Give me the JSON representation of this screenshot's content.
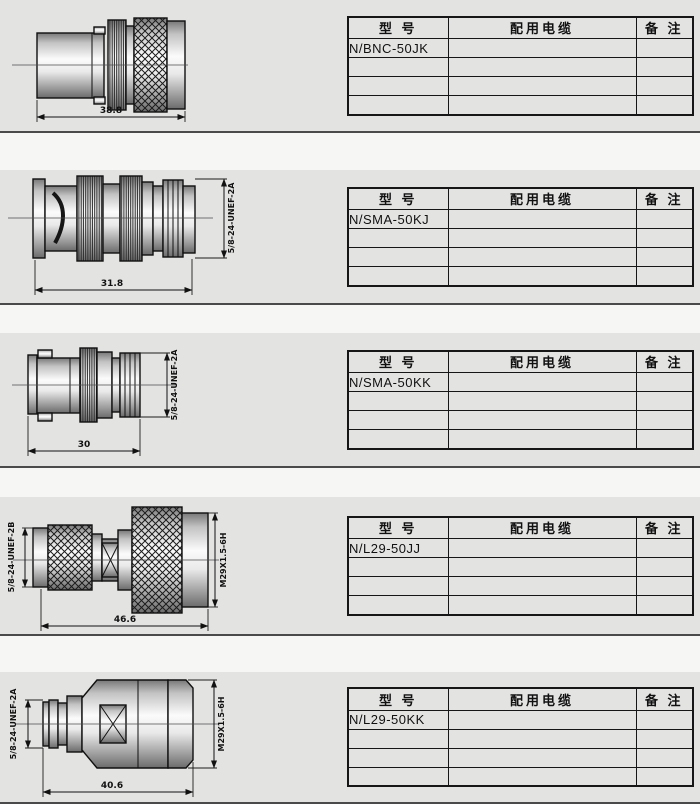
{
  "colors": {
    "panel_bg": "#e3e3e2",
    "page_bg": "#f6f6f5",
    "table_border": "#161616",
    "line_color": "#101010"
  },
  "table_header": {
    "model": "型  号",
    "cable": "配用电缆",
    "remark": "备  注"
  },
  "sections": [
    {
      "model": "N/BNC-50JK",
      "dimension": "38.8"
    },
    {
      "model": "N/SMA-50KJ",
      "dimension": "31.8",
      "thread_right": "5/8-24-UNEF-2A"
    },
    {
      "model": "N/SMA-50KK",
      "dimension": "30",
      "thread_right": "5/8-24-UNEF-2A"
    },
    {
      "model": "N/L29-50JJ",
      "dimension": "46.6",
      "thread_left": "5/8-24-UNEF-2B",
      "thread_right": "M29X1.5-6H"
    },
    {
      "model": "N/L29-50KK",
      "dimension": "40.6",
      "thread_left": "5/8-24-UNEF-2A",
      "thread_right": "M29X1.5-6H"
    }
  ]
}
